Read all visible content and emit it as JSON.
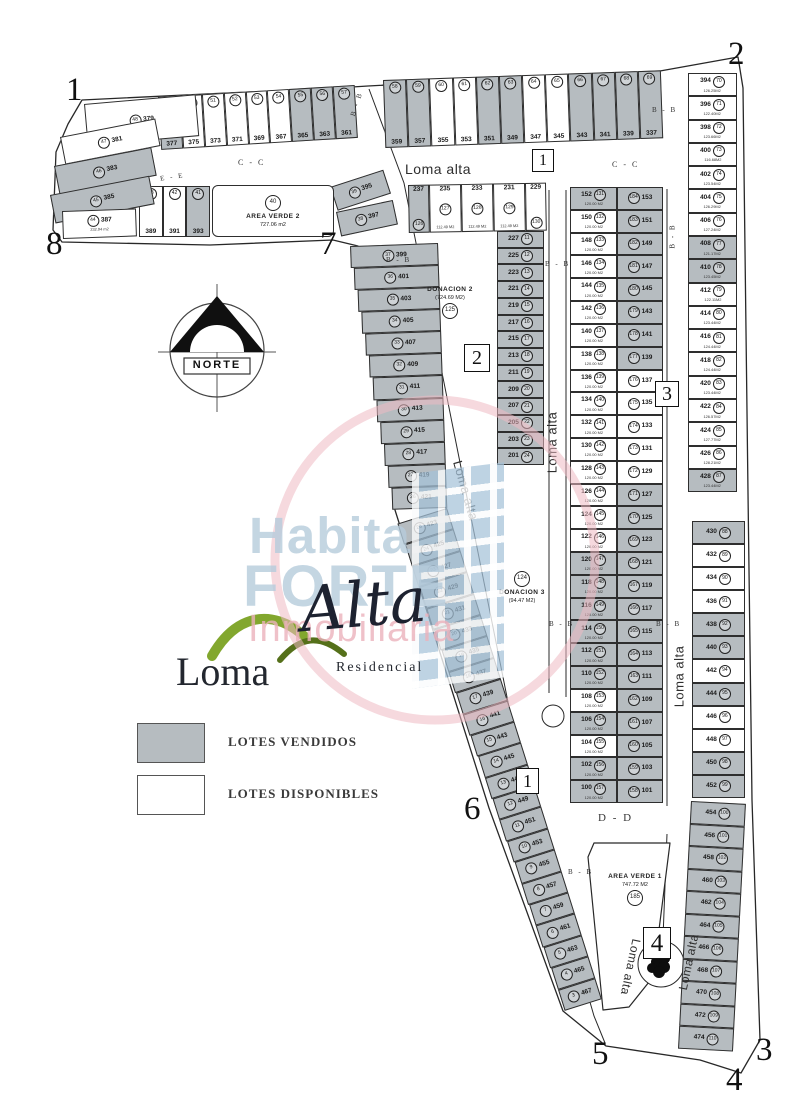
{
  "corners": {
    "c1": "1",
    "c2": "2",
    "c3": "3",
    "c4": "4",
    "c5": "5",
    "c6": "6",
    "c7": "7",
    "c8": "8"
  },
  "markers": {
    "m1": "1",
    "m2": "2",
    "m3": "3",
    "m4": "4"
  },
  "streets": {
    "loma_alta": "Loma alta",
    "bb": "B - B",
    "cc": "C - C",
    "dd": "D - D",
    "ee": "E - E"
  },
  "north": {
    "label": "NORTE"
  },
  "legend": {
    "sold_label": "LOTES VENDIDOS",
    "available_label": "LOTES DISPONIBLES",
    "sold_color": "#b6bcc0",
    "available_color": "#ffffff"
  },
  "watermark": {
    "line1": "Habita",
    "line2": "FORTE",
    "line3": "Inmobiliaria",
    "blue": "#b6ccdc",
    "pink": "#ecb2bc"
  },
  "logo": {
    "name_1": "Loma",
    "name_2": "Alta",
    "subtitle": "Residencial",
    "green": "#82a72e"
  },
  "zones": {
    "area_verde_2": {
      "id": "40",
      "name": "AREA VERDE 2",
      "area": "727.06 m2"
    },
    "area_verde_1": {
      "id": "185",
      "name": "AREA VERDE 1",
      "area": "747.72 M2"
    },
    "donacion_2": {
      "id": "125",
      "name": "DONACION 2",
      "area": "(724.69 M2)"
    },
    "donacion_3": {
      "id": "124",
      "name": "DONACION 3",
      "area": "(94.47 M2)"
    }
  },
  "groups": {
    "row_a": {
      "lots": [
        {
          "n": "377",
          "id": "49",
          "sold": true
        },
        {
          "n": "375",
          "id": "50",
          "sold": false
        },
        {
          "n": "373",
          "id": "51",
          "sold": false
        },
        {
          "n": "371",
          "id": "52",
          "sold": false
        },
        {
          "n": "369",
          "id": "53",
          "sold": false
        },
        {
          "n": "367",
          "id": "54",
          "sold": false
        },
        {
          "n": "365",
          "id": "55",
          "sold": true
        },
        {
          "n": "363",
          "id": "56",
          "sold": true
        },
        {
          "n": "361",
          "id": "57",
          "sold": true
        }
      ]
    },
    "row_b": {
      "lots": [
        {
          "n": "359",
          "id": "58",
          "sold": true
        },
        {
          "n": "357",
          "id": "59",
          "sold": true
        },
        {
          "n": "355",
          "id": "60",
          "sold": false
        },
        {
          "n": "353",
          "id": "61",
          "sold": false
        },
        {
          "n": "351",
          "id": "62",
          "sold": true
        },
        {
          "n": "349",
          "id": "63",
          "sold": true
        },
        {
          "n": "347",
          "id": "64",
          "sold": false
        },
        {
          "n": "345",
          "id": "65",
          "sold": false
        },
        {
          "n": "343",
          "id": "66",
          "sold": true
        },
        {
          "n": "341",
          "id": "67",
          "sold": true
        },
        {
          "n": "339",
          "id": "68",
          "sold": true
        },
        {
          "n": "337",
          "id": "69",
          "sold": true
        }
      ]
    },
    "left_block": {
      "lots": [
        {
          "n": "379",
          "id": "48",
          "sold": false
        },
        {
          "n": "381",
          "id": "47",
          "sold": false
        },
        {
          "n": "383",
          "id": "46",
          "sold": true
        },
        {
          "n": "385",
          "id": "45",
          "sold": true
        },
        {
          "n": "387",
          "id": "44",
          "sold": false,
          "area": "232.94 m2"
        }
      ]
    },
    "row_c": {
      "lots": [
        {
          "n": "389",
          "id": "43",
          "sold": false
        },
        {
          "n": "391",
          "id": "42",
          "sold": false
        },
        {
          "n": "393",
          "id": "41",
          "sold": true
        }
      ]
    },
    "pre_strip": {
      "lots": [
        {
          "n": "395",
          "id": "39",
          "sold": true
        },
        {
          "n": "397",
          "id": "38",
          "sold": true
        }
      ]
    },
    "strip_a": {
      "lots": [
        {
          "n": "399",
          "id": "37",
          "sold": true
        },
        {
          "n": "401",
          "id": "36",
          "sold": true
        },
        {
          "n": "403",
          "id": "35",
          "sold": true
        },
        {
          "n": "405",
          "id": "34",
          "sold": true
        },
        {
          "n": "407",
          "id": "33",
          "sold": true
        },
        {
          "n": "409",
          "id": "32",
          "sold": true
        },
        {
          "n": "411",
          "id": "31",
          "sold": true
        },
        {
          "n": "413",
          "id": "30",
          "sold": true
        },
        {
          "n": "415",
          "id": "29",
          "sold": true
        },
        {
          "n": "417",
          "id": "28",
          "sold": true
        },
        {
          "n": "419",
          "id": "27",
          "sold": true
        },
        {
          "n": "421",
          "id": "26",
          "sold": true
        }
      ]
    },
    "strip_b": {
      "lots": [
        {
          "n": "423",
          "id": "25",
          "sold": true
        },
        {
          "n": "425",
          "id": "24",
          "sold": true
        },
        {
          "n": "427",
          "id": "23",
          "sold": true
        },
        {
          "n": "429",
          "id": "22",
          "sold": true
        },
        {
          "n": "431",
          "id": "21",
          "sold": true
        },
        {
          "n": "433",
          "id": "20",
          "sold": true
        },
        {
          "n": "435",
          "id": "19",
          "sold": true
        },
        {
          "n": "437",
          "id": "18",
          "sold": true
        },
        {
          "n": "439",
          "id": "17",
          "sold": true
        },
        {
          "n": "441",
          "id": "16",
          "sold": true
        },
        {
          "n": "443",
          "id": "15",
          "sold": true
        },
        {
          "n": "445",
          "id": "14",
          "sold": true
        },
        {
          "n": "447",
          "id": "13",
          "sold": true
        },
        {
          "n": "449",
          "id": "12",
          "sold": true
        },
        {
          "n": "451",
          "id": "11",
          "sold": true
        },
        {
          "n": "453",
          "id": "10",
          "sold": true
        },
        {
          "n": "455",
          "id": "9",
          "sold": true
        },
        {
          "n": "457",
          "id": "8",
          "sold": true
        },
        {
          "n": "459",
          "id": "7",
          "sold": true
        },
        {
          "n": "461",
          "id": "6",
          "sold": true
        },
        {
          "n": "463",
          "id": "5",
          "sold": true
        },
        {
          "n": "465",
          "id": "4",
          "sold": true
        },
        {
          "n": "467",
          "id": "3",
          "sold": true
        }
      ]
    },
    "mid_row": {
      "lots": [
        {
          "n": "237",
          "id": "126",
          "sold": true
        },
        {
          "n": "235",
          "id": "127",
          "sold": false,
          "area": "112.49 M2"
        },
        {
          "n": "233",
          "id": "128",
          "sold": false,
          "area": "112.49 M2"
        },
        {
          "n": "231",
          "id": "129",
          "sold": false,
          "area": "112.49 M2"
        },
        {
          "n": "229",
          "id": "130",
          "sold": false
        }
      ]
    },
    "mid_col": {
      "lots": [
        {
          "n": "227",
          "id": "11",
          "sold": true
        },
        {
          "n": "225",
          "id": "12",
          "sold": true
        },
        {
          "n": "223",
          "id": "13",
          "sold": true
        },
        {
          "n": "221",
          "id": "14",
          "sold": true
        },
        {
          "n": "219",
          "id": "15",
          "sold": true
        },
        {
          "n": "217",
          "id": "16",
          "sold": true
        },
        {
          "n": "215",
          "id": "17",
          "sold": true
        },
        {
          "n": "213",
          "id": "18",
          "sold": true
        },
        {
          "n": "211",
          "id": "19",
          "sold": true
        },
        {
          "n": "209",
          "id": "20",
          "sold": true
        },
        {
          "n": "207",
          "id": "21",
          "sold": true
        },
        {
          "n": "205",
          "id": "22",
          "sold": true
        },
        {
          "n": "203",
          "id": "23",
          "sold": true
        },
        {
          "n": "201",
          "id": "24",
          "sold": true
        }
      ]
    },
    "dbl_l": {
      "lots": [
        {
          "n": "152",
          "id": "131",
          "sold": true,
          "area": "120.00 M2"
        },
        {
          "n": "150",
          "id": "132",
          "sold": false,
          "area": "120.00 M2"
        },
        {
          "n": "148",
          "id": "133",
          "sold": false,
          "area": "120.00 M2"
        },
        {
          "n": "146",
          "id": "134",
          "sold": false,
          "area": "120.00 M2"
        },
        {
          "n": "144",
          "id": "135",
          "sold": false,
          "area": "120.00 M2"
        },
        {
          "n": "142",
          "id": "136",
          "sold": false,
          "area": "120.00 M2"
        },
        {
          "n": "140",
          "id": "137",
          "sold": false,
          "area": "120.00 M2"
        },
        {
          "n": "138",
          "id": "138",
          "sold": false,
          "area": "120.00 M2"
        },
        {
          "n": "136",
          "id": "139",
          "sold": false,
          "area": "120.00 M2"
        },
        {
          "n": "134",
          "id": "140",
          "sold": false,
          "area": "120.00 M2"
        },
        {
          "n": "132",
          "id": "141",
          "sold": false,
          "area": "120.00 M2"
        },
        {
          "n": "130",
          "id": "142",
          "sold": false,
          "area": "120.00 M2"
        },
        {
          "n": "128",
          "id": "143",
          "sold": false,
          "area": "120.00 M2"
        },
        {
          "n": "126",
          "id": "144",
          "sold": false,
          "area": "120.00 M2"
        },
        {
          "n": "124",
          "id": "145",
          "sold": false,
          "area": "120.00 M2"
        },
        {
          "n": "122",
          "id": "146",
          "sold": false,
          "area": "120.00 M2"
        },
        {
          "n": "120",
          "id": "147",
          "sold": true,
          "area": "120.00 M2"
        },
        {
          "n": "118",
          "id": "148",
          "sold": true,
          "area": "120.00 M2"
        },
        {
          "n": "116",
          "id": "149",
          "sold": true,
          "area": "120.00 M2"
        },
        {
          "n": "114",
          "id": "150",
          "sold": true,
          "area": "120.00 M2"
        },
        {
          "n": "112",
          "id": "151",
          "sold": true,
          "area": "120.00 M2"
        },
        {
          "n": "110",
          "id": "152",
          "sold": true,
          "area": "120.00 M2"
        },
        {
          "n": "108",
          "id": "153",
          "sold": false,
          "area": "120.00 M2"
        },
        {
          "n": "106",
          "id": "154",
          "sold": true,
          "area": "120.00 M2"
        },
        {
          "n": "104",
          "id": "155",
          "sold": false,
          "area": "120.00 M2"
        },
        {
          "n": "102",
          "id": "156",
          "sold": true,
          "area": "120.00 M2"
        },
        {
          "n": "100",
          "id": "157",
          "sold": true,
          "area": "120.00 M2"
        }
      ]
    },
    "dbl_r": {
      "lots": [
        {
          "n": "153",
          "id": "184",
          "sold": true
        },
        {
          "n": "151",
          "id": "183",
          "sold": true
        },
        {
          "n": "149",
          "id": "182",
          "sold": true
        },
        {
          "n": "147",
          "id": "181",
          "sold": true
        },
        {
          "n": "145",
          "id": "180",
          "sold": true
        },
        {
          "n": "143",
          "id": "179",
          "sold": true
        },
        {
          "n": "141",
          "id": "178",
          "sold": true
        },
        {
          "n": "139",
          "id": "177",
          "sold": true
        },
        {
          "n": "137",
          "id": "176",
          "sold": false
        },
        {
          "n": "135",
          "id": "175",
          "sold": false
        },
        {
          "n": "133",
          "id": "174",
          "sold": false
        },
        {
          "n": "131",
          "id": "173",
          "sold": false
        },
        {
          "n": "129",
          "id": "172",
          "sold": false
        },
        {
          "n": "127",
          "id": "171",
          "sold": true
        },
        {
          "n": "125",
          "id": "170",
          "sold": true
        },
        {
          "n": "123",
          "id": "169",
          "sold": true
        },
        {
          "n": "121",
          "id": "168",
          "sold": true
        },
        {
          "n": "119",
          "id": "167",
          "sold": true
        },
        {
          "n": "117",
          "id": "166",
          "sold": true
        },
        {
          "n": "115",
          "id": "165",
          "sold": true
        },
        {
          "n": "113",
          "id": "164",
          "sold": true
        },
        {
          "n": "111",
          "id": "163",
          "sold": true
        },
        {
          "n": "109",
          "id": "162",
          "sold": true
        },
        {
          "n": "107",
          "id": "161",
          "sold": true
        },
        {
          "n": "105",
          "id": "160",
          "sold": true
        },
        {
          "n": "103",
          "id": "159",
          "sold": true
        },
        {
          "n": "101",
          "id": "158",
          "sold": true
        }
      ]
    },
    "col_1": {
      "lots": [
        {
          "n": "394",
          "id": "70",
          "sold": false,
          "area": "126.25M2"
        },
        {
          "n": "396",
          "id": "71",
          "sold": false,
          "area": "122.40M2"
        },
        {
          "n": "398",
          "id": "72",
          "sold": false,
          "area": "123.66M2"
        },
        {
          "n": "400",
          "id": "73",
          "sold": false,
          "area": "116.68M2"
        },
        {
          "n": "402",
          "id": "74",
          "sold": false,
          "area": "123.54M2"
        },
        {
          "n": "404",
          "id": "75",
          "sold": false,
          "area": "126.29M2"
        },
        {
          "n": "406",
          "id": "76",
          "sold": false,
          "area": "127.24M2"
        },
        {
          "n": "408",
          "id": "77",
          "sold": true,
          "area": "121.17M2"
        },
        {
          "n": "410",
          "id": "78",
          "sold": true,
          "area": "123.45M2"
        },
        {
          "n": "412",
          "id": "79",
          "sold": false,
          "area": "122.11M2"
        },
        {
          "n": "414",
          "id": "80",
          "sold": false,
          "area": "123.44M2"
        },
        {
          "n": "416",
          "id": "81",
          "sold": false,
          "area": "124.44M2"
        },
        {
          "n": "418",
          "id": "82",
          "sold": false,
          "area": "124.44M2"
        },
        {
          "n": "420",
          "id": "83",
          "sold": false,
          "area": "123.44M2"
        },
        {
          "n": "422",
          "id": "84",
          "sold": false,
          "area": "126.57M2"
        },
        {
          "n": "424",
          "id": "85",
          "sold": false,
          "area": "127.77M2"
        },
        {
          "n": "426",
          "id": "86",
          "sold": false,
          "area": "128.21M2"
        },
        {
          "n": "428",
          "id": "87",
          "sold": true,
          "area": "123.44M2"
        }
      ]
    },
    "col_2": {
      "lots": [
        {
          "n": "430",
          "id": "88",
          "sold": true
        },
        {
          "n": "432",
          "id": "89",
          "sold": false
        },
        {
          "n": "434",
          "id": "90",
          "sold": false
        },
        {
          "n": "436",
          "id": "91",
          "sold": false
        },
        {
          "n": "438",
          "id": "92",
          "sold": true
        },
        {
          "n": "440",
          "id": "93",
          "sold": true
        },
        {
          "n": "442",
          "id": "94",
          "sold": false
        },
        {
          "n": "444",
          "id": "95",
          "sold": true
        },
        {
          "n": "446",
          "id": "96",
          "sold": false
        },
        {
          "n": "448",
          "id": "97",
          "sold": false
        },
        {
          "n": "450",
          "id": "98",
          "sold": true
        },
        {
          "n": "452",
          "id": "99",
          "sold": true
        }
      ]
    },
    "col_3": {
      "lots": [
        {
          "n": "454",
          "id": "100",
          "sold": true
        },
        {
          "n": "456",
          "id": "101",
          "sold": true
        },
        {
          "n": "458",
          "id": "102",
          "sold": true
        },
        {
          "n": "460",
          "id": "103",
          "sold": true
        },
        {
          "n": "462",
          "id": "104",
          "sold": true
        },
        {
          "n": "464",
          "id": "105",
          "sold": true
        },
        {
          "n": "466",
          "id": "106",
          "sold": true
        },
        {
          "n": "468",
          "id": "107",
          "sold": true
        },
        {
          "n": "470",
          "id": "108",
          "sold": true
        },
        {
          "n": "472",
          "id": "109",
          "sold": true
        },
        {
          "n": "474",
          "id": "110",
          "sold": true
        }
      ]
    }
  }
}
